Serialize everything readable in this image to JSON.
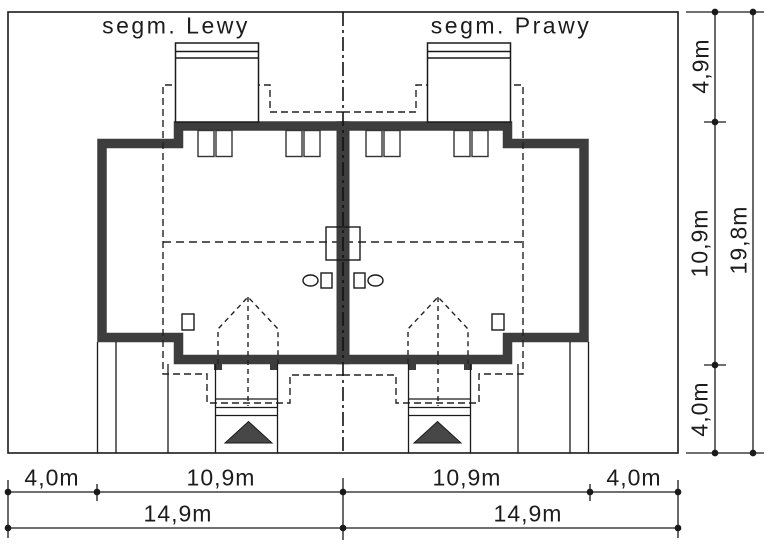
{
  "drawing": {
    "segment_left_label": "segm. Lewy",
    "segment_right_label": "segm. Prawy"
  },
  "dimensions": {
    "vertical_segments": {
      "top": "4,9m",
      "middle": "10,9m",
      "bottom": "4,0m"
    },
    "vertical_total": "19,8m",
    "horizontal_segments": {
      "left_margin": "4,0m",
      "left_width": "10,9m",
      "right_width": "10,9m",
      "right_margin": "4,0m"
    },
    "horizontal_totals": {
      "left": "14,9m",
      "right": "14,9m"
    }
  },
  "icons": {
    "entrance_arrow_left": "entrance-arrow",
    "entrance_arrow_right": "entrance-arrow"
  },
  "colors": {
    "background": "#ffffff",
    "line": "#1a1a1a",
    "wall_fill": "#3d3d3d",
    "arrow_fill": "#474747"
  }
}
